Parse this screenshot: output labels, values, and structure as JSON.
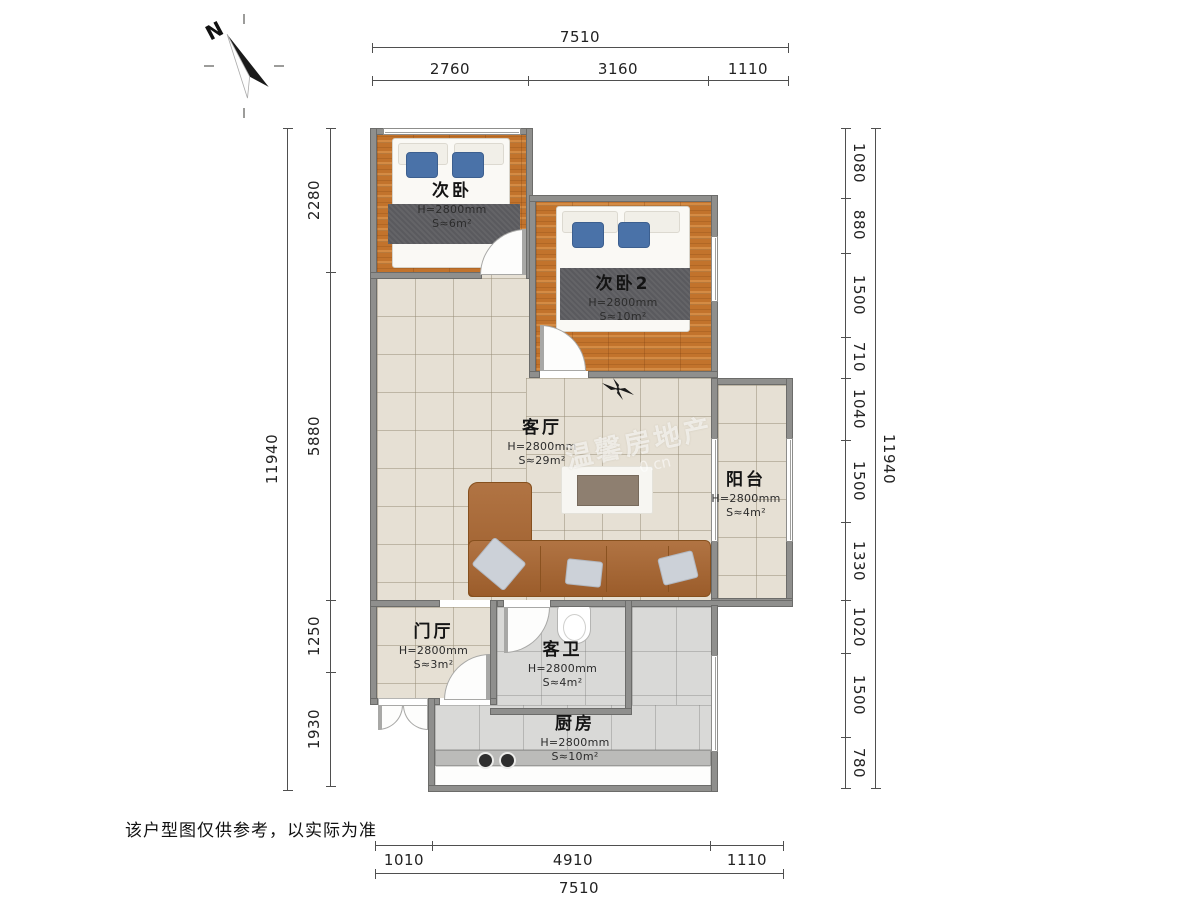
{
  "compass": {
    "label": "N"
  },
  "disclaimer": "该户型图仅供参考，以实际为准",
  "watermark": {
    "brand": "温馨房地产",
    "url_fragment": "0.cn"
  },
  "rooms": {
    "bedroom1": {
      "name": "次卧",
      "height": "H=2800mm",
      "area": "S≈6m²"
    },
    "bedroom2": {
      "name": "次卧2",
      "height": "H=2800mm",
      "area": "S≈10m²"
    },
    "living": {
      "name": "客厅",
      "height": "H=2800mm",
      "area": "S≈29m²"
    },
    "balcony": {
      "name": "阳台",
      "height": "H=2800mm",
      "area": "S≈4m²"
    },
    "hall": {
      "name": "门厅",
      "height": "H=2800mm",
      "area": "S≈3m²"
    },
    "bath": {
      "name": "客卫",
      "height": "H=2800mm",
      "area": "S≈4m²"
    },
    "kitchen": {
      "name": "厨房",
      "height": "H=2800mm",
      "area": "S≈10m²"
    }
  },
  "dims": {
    "top": {
      "total": "7510",
      "segments": [
        "2760",
        "3160",
        "1110"
      ]
    },
    "bottom": {
      "total": "7510",
      "segments": [
        "1010",
        "4910",
        "1110"
      ]
    },
    "left": {
      "total": "11940",
      "segments": [
        "2280",
        "5880",
        "1250",
        "1930"
      ]
    },
    "right": {
      "total": "11940",
      "segments": [
        "1080",
        "880",
        "1500",
        "710",
        "1040",
        "1500",
        "1330",
        "1020",
        "1500",
        "780"
      ]
    }
  },
  "colors": {
    "wood": "#c2732c",
    "tile_beige": "#e6e0d4",
    "tile_gray": "#d9d9d7",
    "wall": "#8f8f8d",
    "sofa": "#a8642e",
    "pillow_blue": "#4a72a8",
    "dim_text": "#222222"
  }
}
